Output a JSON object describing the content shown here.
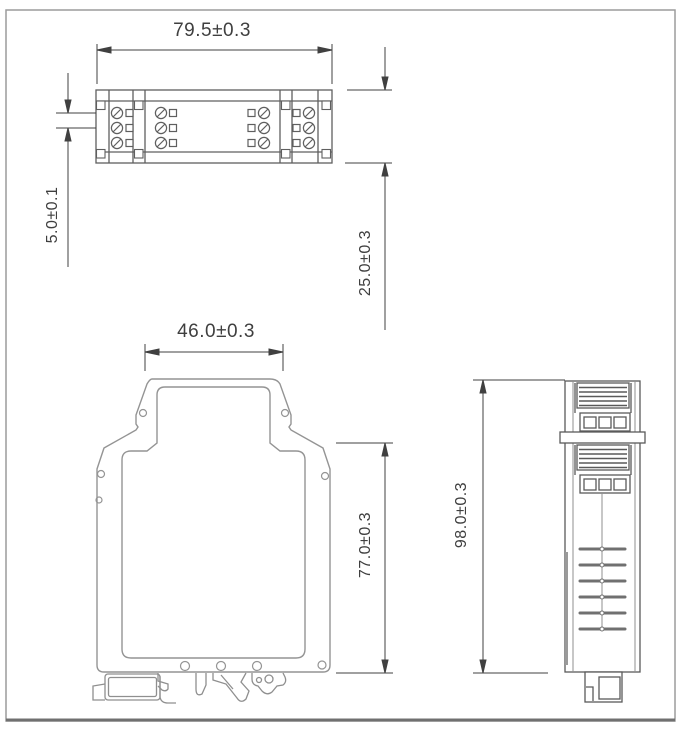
{
  "drawing": {
    "dimensions": {
      "top_width": "79.5±0.3",
      "terminal_pitch": "5.0±0.1",
      "module_depth": "25.0±0.3",
      "front_top_width": "46.0±0.3",
      "body_height": "77.0±0.3",
      "overall_height": "98.0±0.3"
    },
    "colors": {
      "outline_light": "#949494",
      "outline_dark": "#5f5f5f",
      "dimension": "#404040",
      "frame": "#9c9c9c",
      "background": "#ffffff"
    }
  }
}
